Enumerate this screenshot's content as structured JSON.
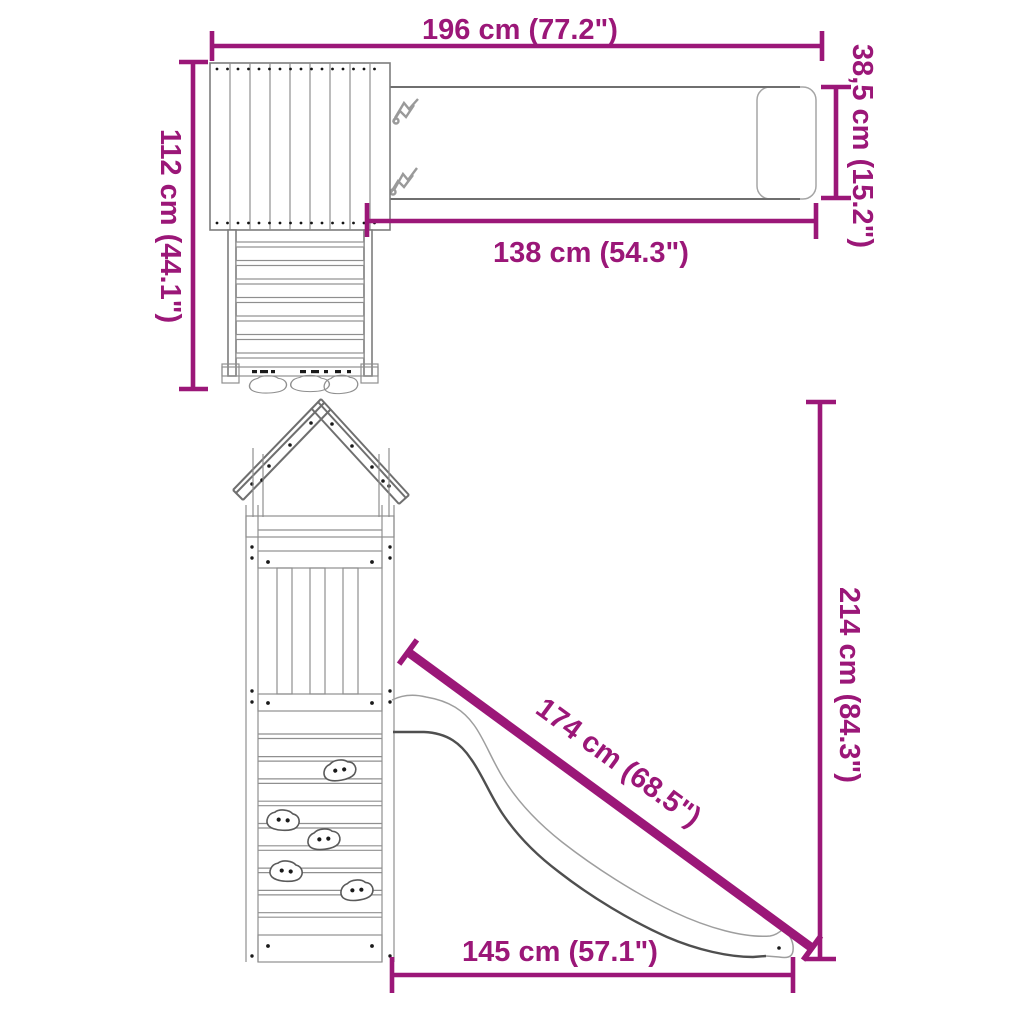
{
  "diagram": {
    "kind": "playset-dimension-drawing",
    "background": "#ffffff"
  },
  "colors": {
    "dimension_accent": "#9B1778",
    "outline_gray": "#7d7d7d",
    "outline_dark": "#6f6f6f",
    "screw_dot": "#1a1a1a"
  },
  "dimensions": {
    "beam_span": {
      "label": "196 cm (77.2\")"
    },
    "beam_height": {
      "label": "38,5 cm (15.2\")"
    },
    "platform_depth": {
      "label": "112 cm (44.1\")"
    },
    "beam_length": {
      "label": "138 cm (54.3\")"
    },
    "total_height": {
      "label": "214 cm (84.3\")"
    },
    "slide_length": {
      "label": "174 cm (68.5\")"
    },
    "base_length": {
      "label": "145 cm (57.1\")"
    }
  }
}
